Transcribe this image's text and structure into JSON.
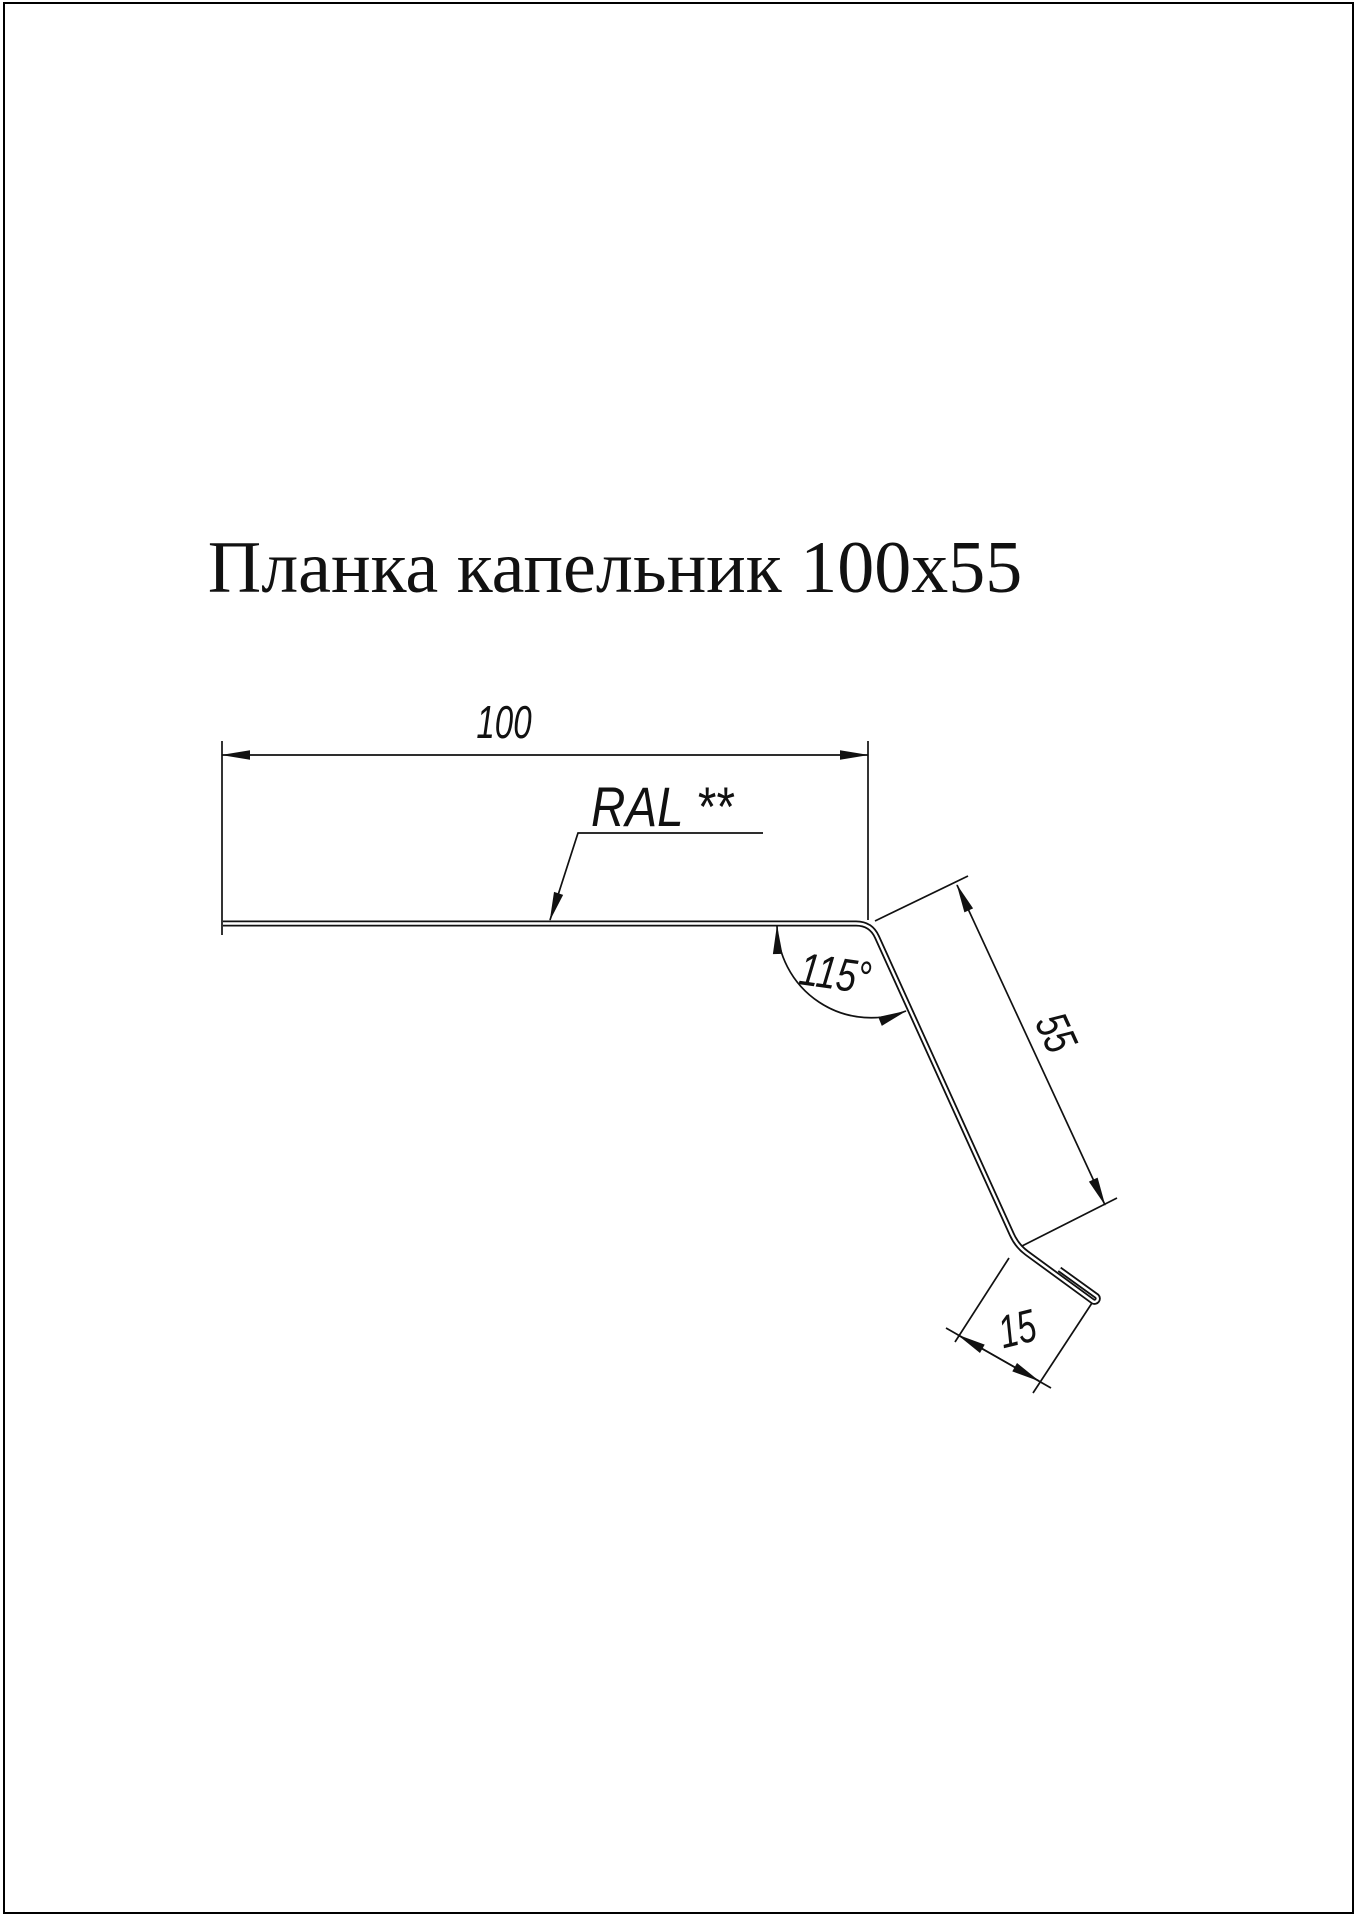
{
  "page": {
    "background_color": "#ffffff",
    "border_color": "#000000",
    "line_color": "#000000"
  },
  "title": {
    "text": "Планка капельник 100x55"
  },
  "drawing": {
    "width_dimension": {
      "value": "100"
    },
    "coating_label": {
      "value": "RAL **"
    },
    "angle_dimension": {
      "value": "115°"
    },
    "drop_dimension": {
      "value": "55"
    },
    "hem_dimension": {
      "value": "15"
    }
  }
}
